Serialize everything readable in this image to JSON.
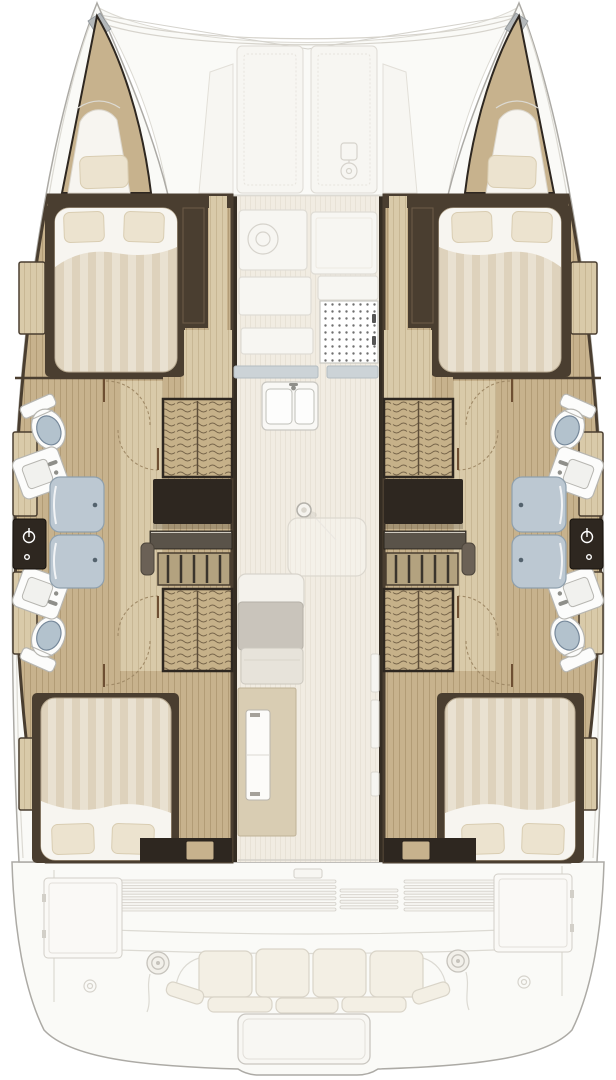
{
  "diagram": {
    "kind": "catamaran accommodation and deck floor plan",
    "orientation": "bow-up",
    "visible_text": "none"
  },
  "fixtures_depicted": {
    "double_berth_cabins": 4,
    "bow_berths": 2,
    "toilets": 4,
    "sinks": 4,
    "shower_stalls": 2,
    "hanging_lockers": 4,
    "companionway_steps": 2,
    "galley_double_sink": 1,
    "galley_stove": 1,
    "salon_table": 1,
    "mast_post": 1,
    "cockpit_bench": 1,
    "cockpit_winches": 2,
    "foredeck_panels": 2,
    "transom_platform": 1
  },
  "colors": {
    "boat_outline": "#acaaa5",
    "deck_white": "#fafaf7",
    "deck_line": "#dcdad3",
    "bow_cap": "#b4b8ba",
    "hull_wood": "#c7b28d",
    "hull_wood_line": "#b29c76",
    "walkway_wood": "#d9caa9",
    "walkway_wood_line": "#c8b794",
    "wardrobe_wood": "#c6b189",
    "wardrobe_line": "#77654a",
    "trim_dark": "#4a3e30",
    "trim_darker": "#2e2720",
    "charcoal": "#3a342c",
    "charcoal_mid": "#5a5349",
    "tread_base": "#b3a27f",
    "handrail": "#6b6156",
    "salon_wall": "#352d23",
    "salon_floor": "#f1ece2",
    "salon_floor_line": "#e8e2d6",
    "counter_white": "#f7f6f2",
    "counter_line": "#dfdcd5",
    "counter_edge": "#ccd3d7",
    "counter_edge_line": "#b3bcc1",
    "stove_dot": "#6f6f6f",
    "fixture_white": "#fcfcfb",
    "fixture_line": "#b7b6b1",
    "metal": "#8f8f8a",
    "toilet_lid": "#b3c2cd",
    "toilet_lid_line": "#76889a",
    "shower_glass": "#bcc8d2",
    "shower_glass_line": "#8fa0ad",
    "handle_dot": "#54636e",
    "bed_sheet": "#f7f5f0",
    "bed_stroke": "#b9ab92",
    "duvet_a": "#e9e1d1",
    "duvet_b": "#ded2bc",
    "pillow": "#ece3cf",
    "pillow_line": "#d9cdb2",
    "cabinet_beige": "#d9cdb3",
    "cabinet_beige_line": "#c0b297",
    "settee_gray": "#c9c4bb",
    "settee_light": "#e7e3da",
    "cushion": "#f3efe4",
    "cushion_line": "#d9d4c8",
    "door_arc": "#a08a67",
    "door_leaf": "#6e4f33",
    "icon_faint": "#d6d3cc",
    "white": "#ffffff"
  }
}
